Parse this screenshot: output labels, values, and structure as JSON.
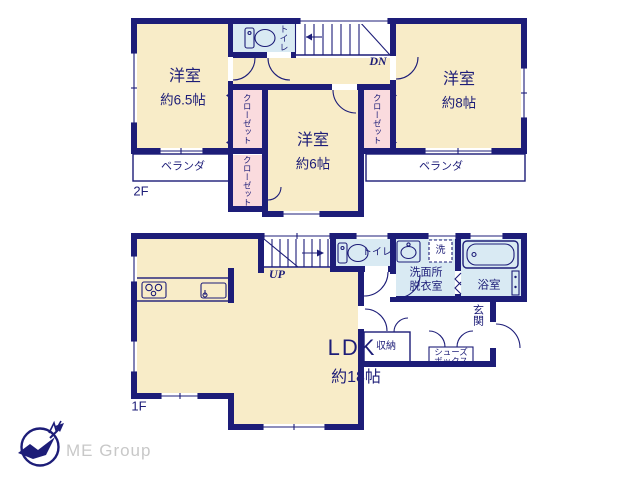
{
  "colors": {
    "wall_navy": "#1d1d78",
    "room_cream": "#f8ecc8",
    "closet_pink": "#fadbde",
    "wet_area_blue": "#d9eaf3",
    "logo_gray": "#c8c8c8",
    "background": "#ffffff"
  },
  "floor2": {
    "floor_label": "2F",
    "room_west": {
      "name": "洋室",
      "size": "約6.5帖"
    },
    "room_center": {
      "name": "洋室",
      "size": "約6帖"
    },
    "room_east": {
      "name": "洋室",
      "size": "約8帖"
    },
    "toilet_label": "トイレ",
    "closet_label": "クローゼット",
    "veranda_label": "ベランダ",
    "stairs_label": "DN"
  },
  "floor1": {
    "floor_label": "1F",
    "ldk": {
      "name": "LDK",
      "size": "約18帖"
    },
    "toilet_label": "トイレ",
    "washroom": {
      "line1": "洗面所",
      "line2": "脱衣室"
    },
    "laundry_label": "洗",
    "bathroom_label": "浴室",
    "entrance_label": "玄関",
    "storage_label": "収納",
    "shoebox": {
      "line1": "シューズ",
      "line2": "ボックス"
    },
    "stairs_label": "UP"
  },
  "logo": {
    "company": "ME Group"
  }
}
